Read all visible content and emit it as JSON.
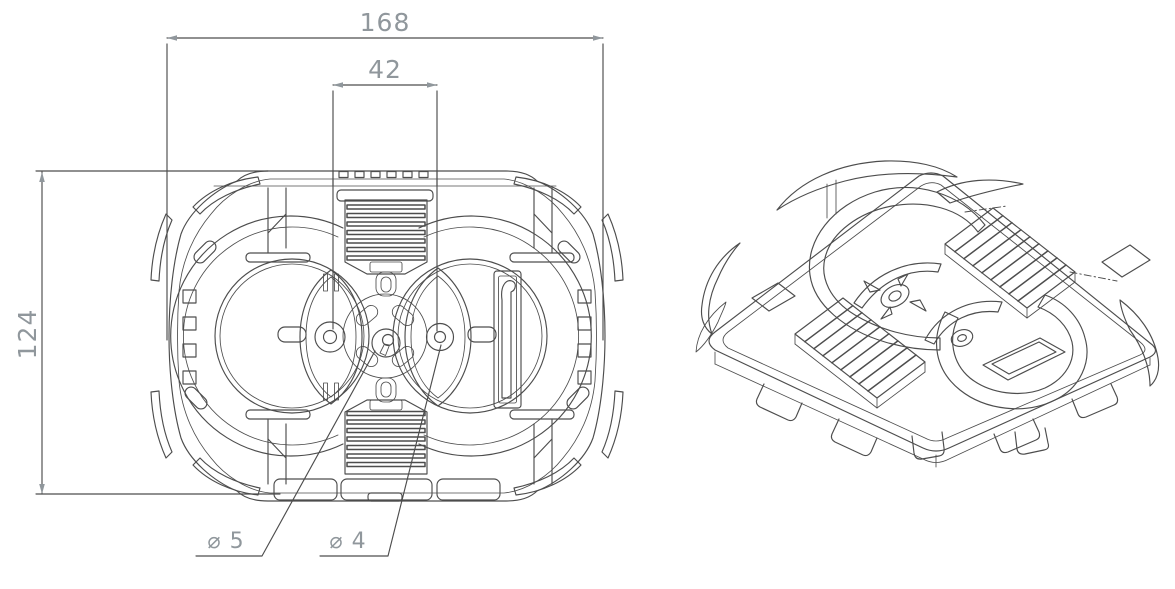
{
  "drawing": {
    "front": {
      "dim_overall_width": "168",
      "dim_hole_spacing": "42",
      "dim_overall_height": "124",
      "dim_center_hole": "⌀ 5",
      "dim_pivot_hole": "⌀ 4"
    },
    "colors": {
      "line": "#4d4d4d",
      "dimension": "#90979c",
      "background": "#ffffff"
    }
  }
}
